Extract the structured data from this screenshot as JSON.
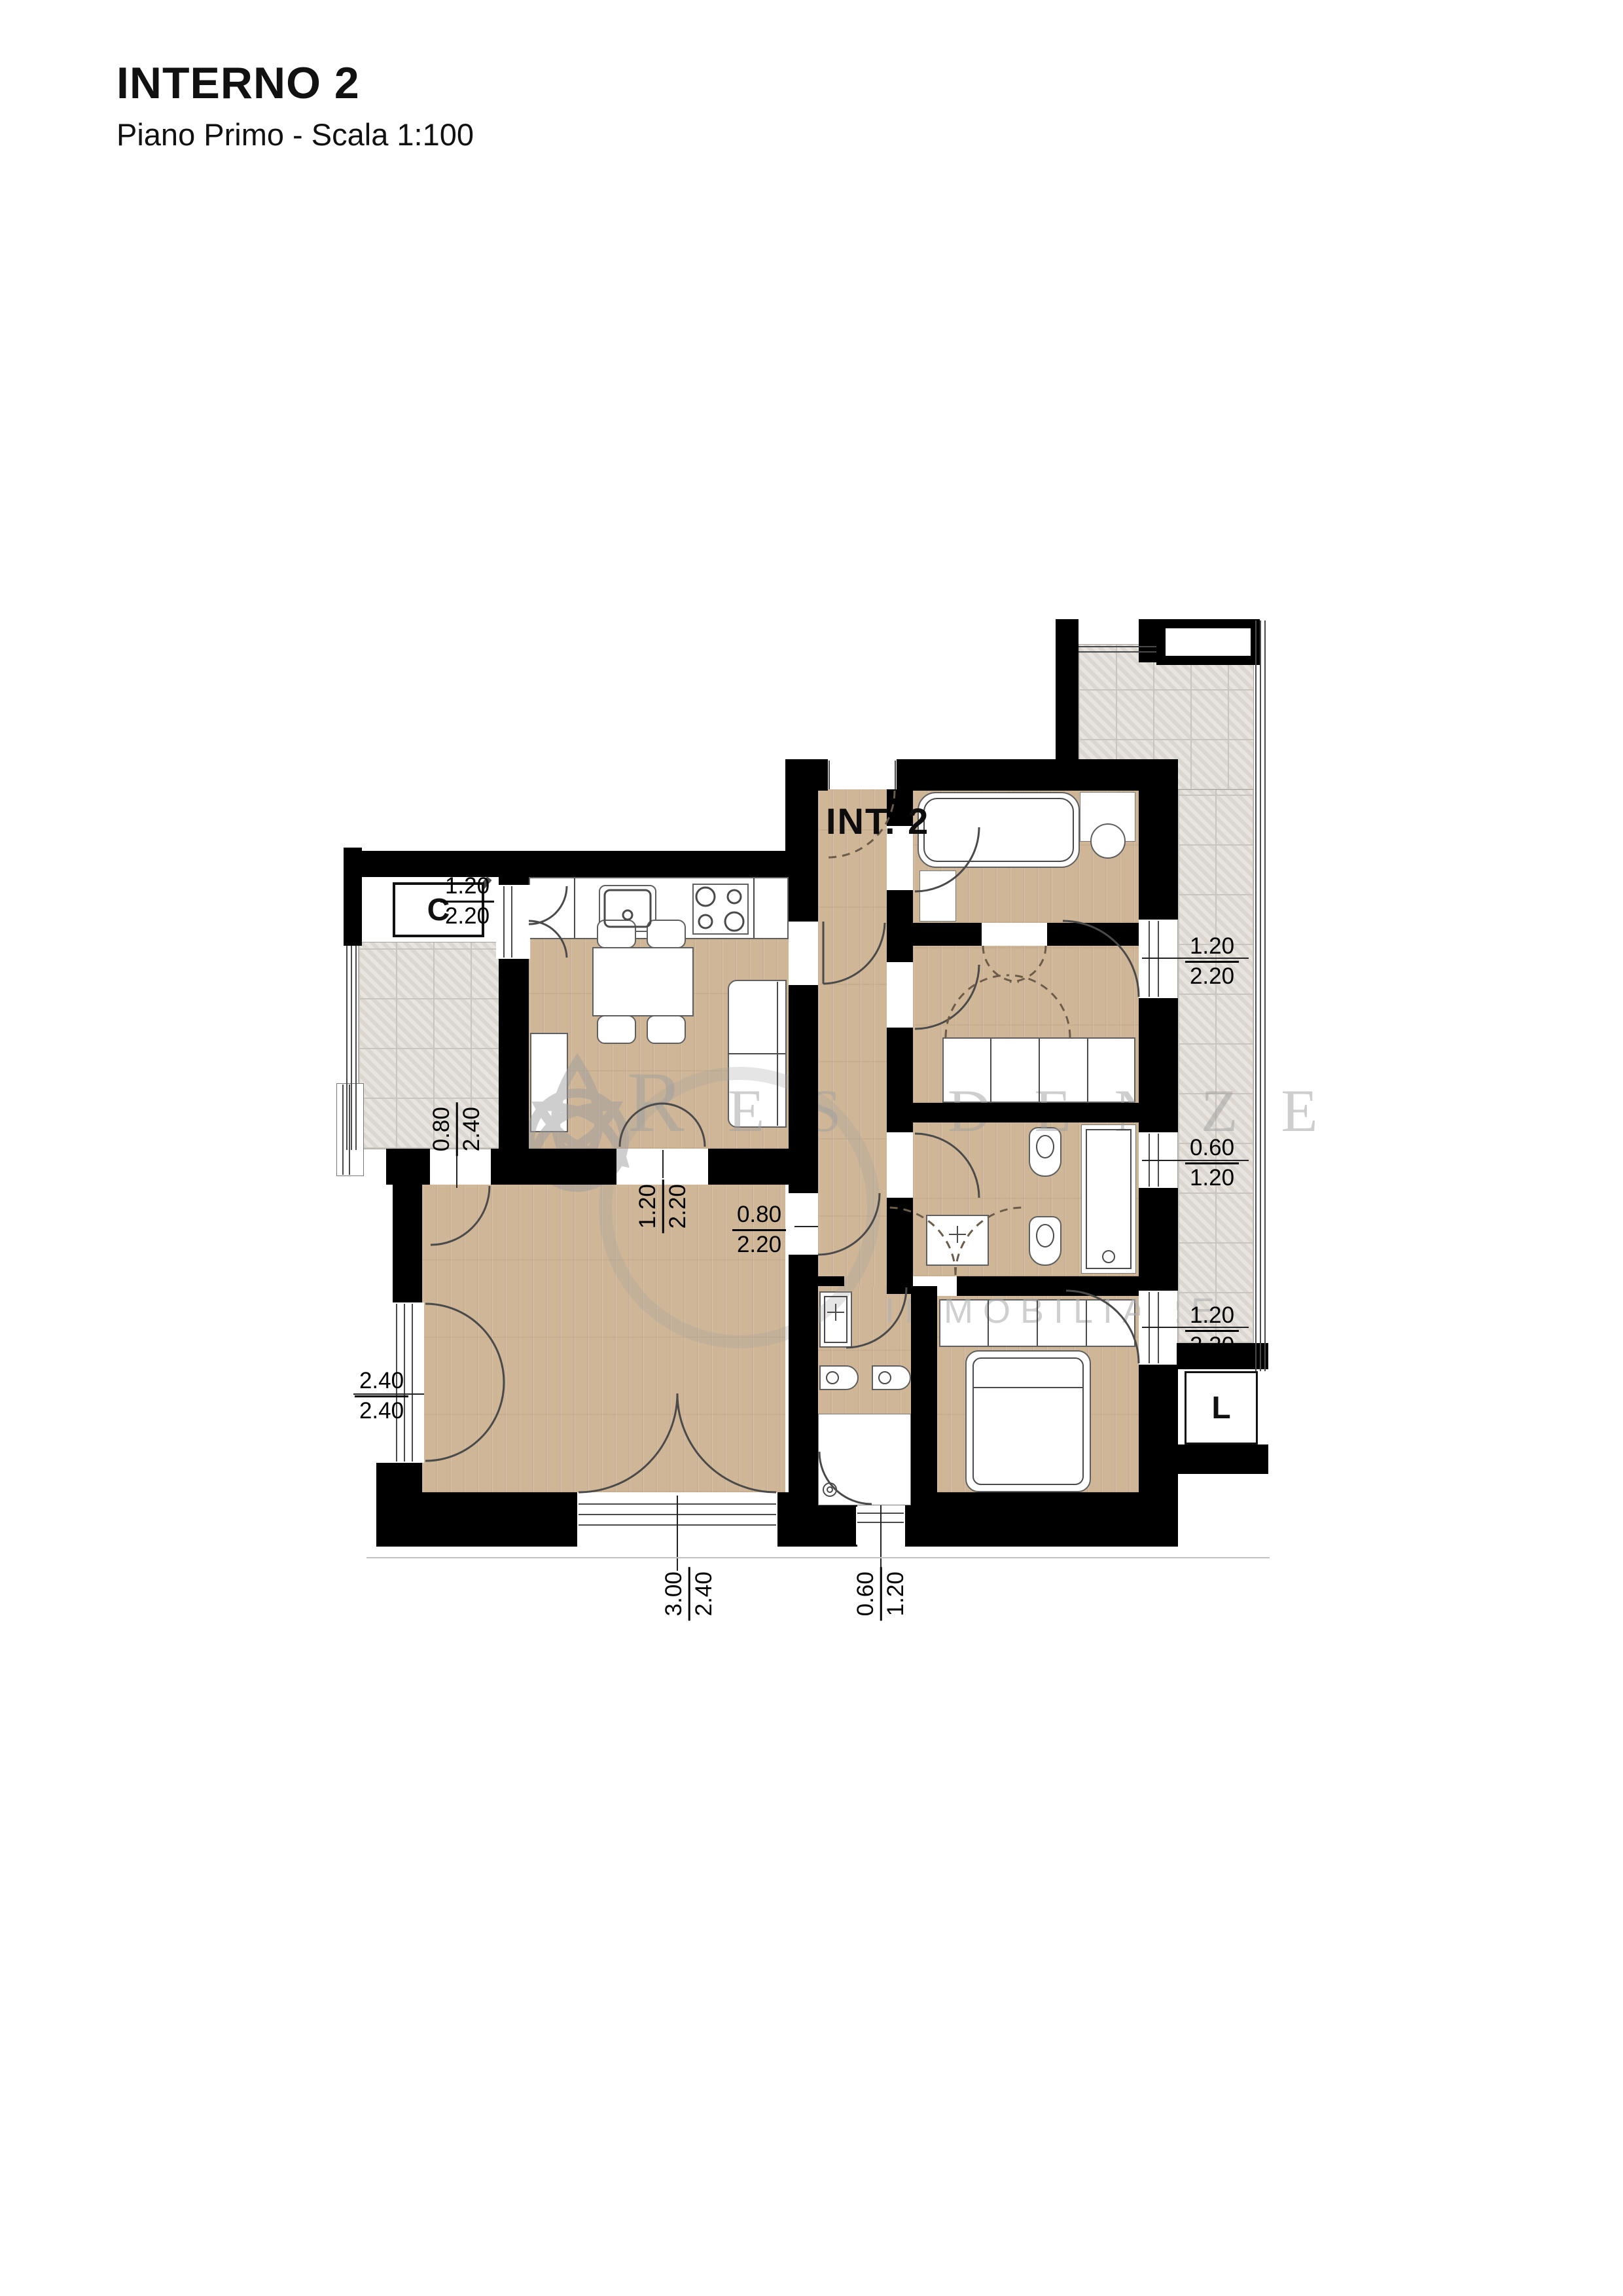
{
  "header": {
    "title": "INTERNO 2",
    "subtitle": "Piano Primo - Scala 1:100"
  },
  "plan": {
    "stair_label": "C",
    "unit_label": "INT. 2",
    "elevator_label": "L",
    "watermark": {
      "brand": "RESIDENZE",
      "sub": "IMMOBILIARE"
    },
    "dimensions": {
      "balcony_kitchen_door": {
        "w": "1.20",
        "h": "2.20"
      },
      "terrace_living_door": {
        "w": "0.80",
        "h": "2.40"
      },
      "living_left_window": {
        "w": "2.40",
        "h": "2.40"
      },
      "living_bottom_window": {
        "w": "3.00",
        "h": "2.40"
      },
      "bath_main_window": {
        "w": "0.60",
        "h": "1.20"
      },
      "kitchen_living_opening": {
        "w": "1.20",
        "h": "2.20"
      },
      "living_hall_door": {
        "w": "0.80",
        "h": "2.20"
      },
      "room2_window": {
        "w": "1.20",
        "h": "2.20"
      },
      "bath_ensuite_window": {
        "w": "0.60",
        "h": "1.20"
      },
      "bedroom_window": {
        "w": "1.20",
        "h": "2.20"
      }
    }
  }
}
